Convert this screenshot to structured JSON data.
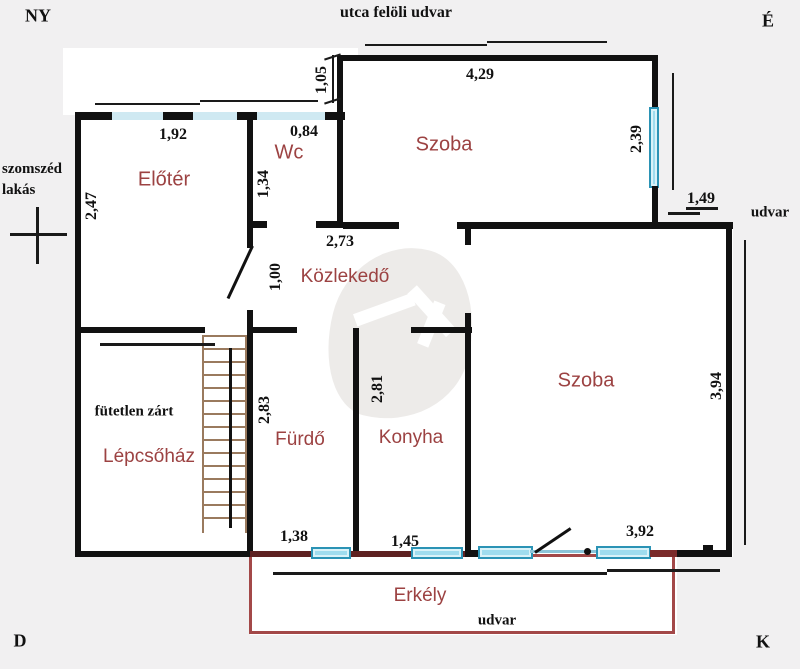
{
  "title": "Lakás alaprajz",
  "compass": {
    "nw": "NY",
    "ne": "É",
    "sw": "D",
    "se": "K"
  },
  "outside": {
    "top_yard": "utca felöli udvar",
    "neighbor_line1": "szomszéd",
    "neighbor_line2": "lakás",
    "right_yard": "udvar",
    "bottom_yard": "udvar",
    "note": "fütetlen zárt"
  },
  "rooms": {
    "entry": "Előtér",
    "wc": "Wc",
    "room_top": "Szoba",
    "corridor": "Közlekedő",
    "bathroom": "Fürdő",
    "kitchen": "Konyha",
    "room_right": "Szoba",
    "staircase": "Lépcsőház",
    "balcony": "Erkély"
  },
  "dims": {
    "d192": "1,92",
    "d084": "0,84",
    "d105": "1,05",
    "d429": "4,29",
    "d239": "2,39",
    "d149": "1,49",
    "d247": "2,47",
    "d134": "1,34",
    "d273": "2,73",
    "d100": "1,00",
    "d283": "2,83",
    "d281": "2,81",
    "d394": "3,94",
    "d138": "1,38",
    "d145": "1,45",
    "d392": "3,92"
  },
  "colors": {
    "background": "#f1f0f1",
    "wall": "#111111",
    "room_label": "#9c4242",
    "window_fill": "#9fdcee",
    "window_border": "#2b93b5",
    "window_band": "#cfe9f2",
    "balcony_outline": "#a34848",
    "bottom_wall": "#5e2121",
    "stairs": "#9a7a5e"
  }
}
